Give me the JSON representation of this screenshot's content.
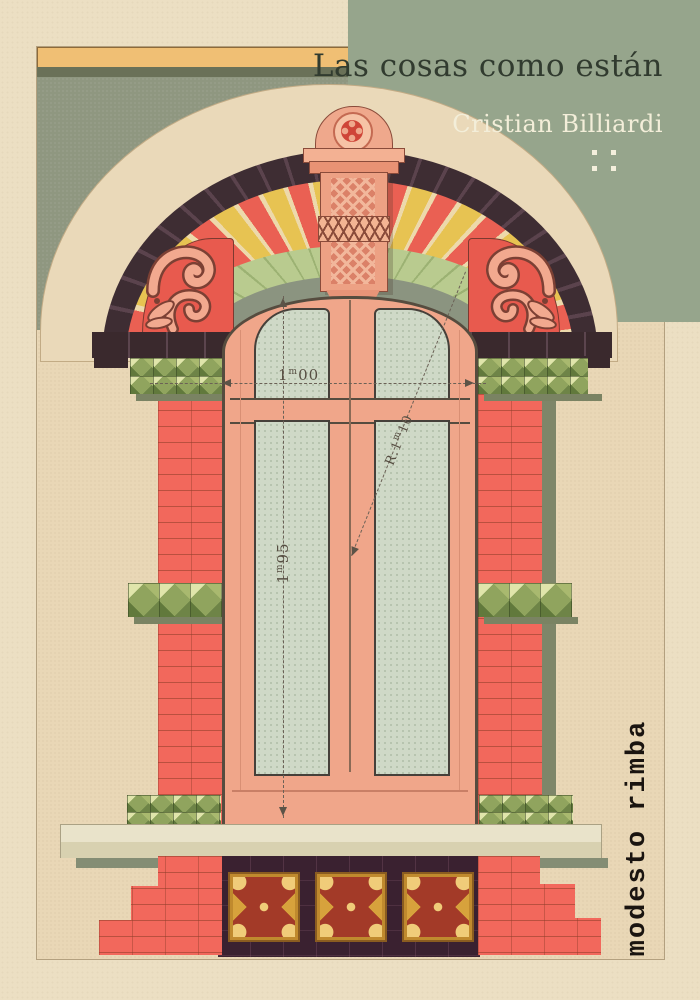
{
  "cover": {
    "title": "Las cosas como están",
    "author": "Cristian Billiardi",
    "publisher": "modesto rimba"
  },
  "illustration": {
    "subject": "polychrome brick and stucco window elevation plate",
    "dimension_labels": {
      "width": {
        "value": "1",
        "unit": "m",
        "decimals": "00"
      },
      "height": {
        "value": "1",
        "unit": "m",
        "decimals": "95"
      },
      "radius": {
        "prefix": "R.",
        "value": "1",
        "unit": "m",
        "decimals": "10"
      }
    }
  },
  "palette": {
    "paper": "#ecdfc3",
    "plate_paper": "#e9d7b6",
    "sage_block": "#96a58c",
    "title_text": "#313b2f",
    "author_text": "#f3eed9",
    "wall": "#8f9780",
    "cornice_yellow": "#f0bf74",
    "brick_red": "#f2685c",
    "stripe_red": "#ea6053",
    "stripe_yellow": "#e7c352",
    "arch_dark": "#3e2d33",
    "ring_green": "#b9cb8f",
    "pyramid_green": "#90a45e",
    "window_salmon": "#f0a68a",
    "glass_green": "#cfd9c7",
    "gold_tile": "#d7a23c",
    "panel_dark": "#3a2130",
    "publisher_text": "#1a1410",
    "dimension_ink": "#5f574a"
  }
}
